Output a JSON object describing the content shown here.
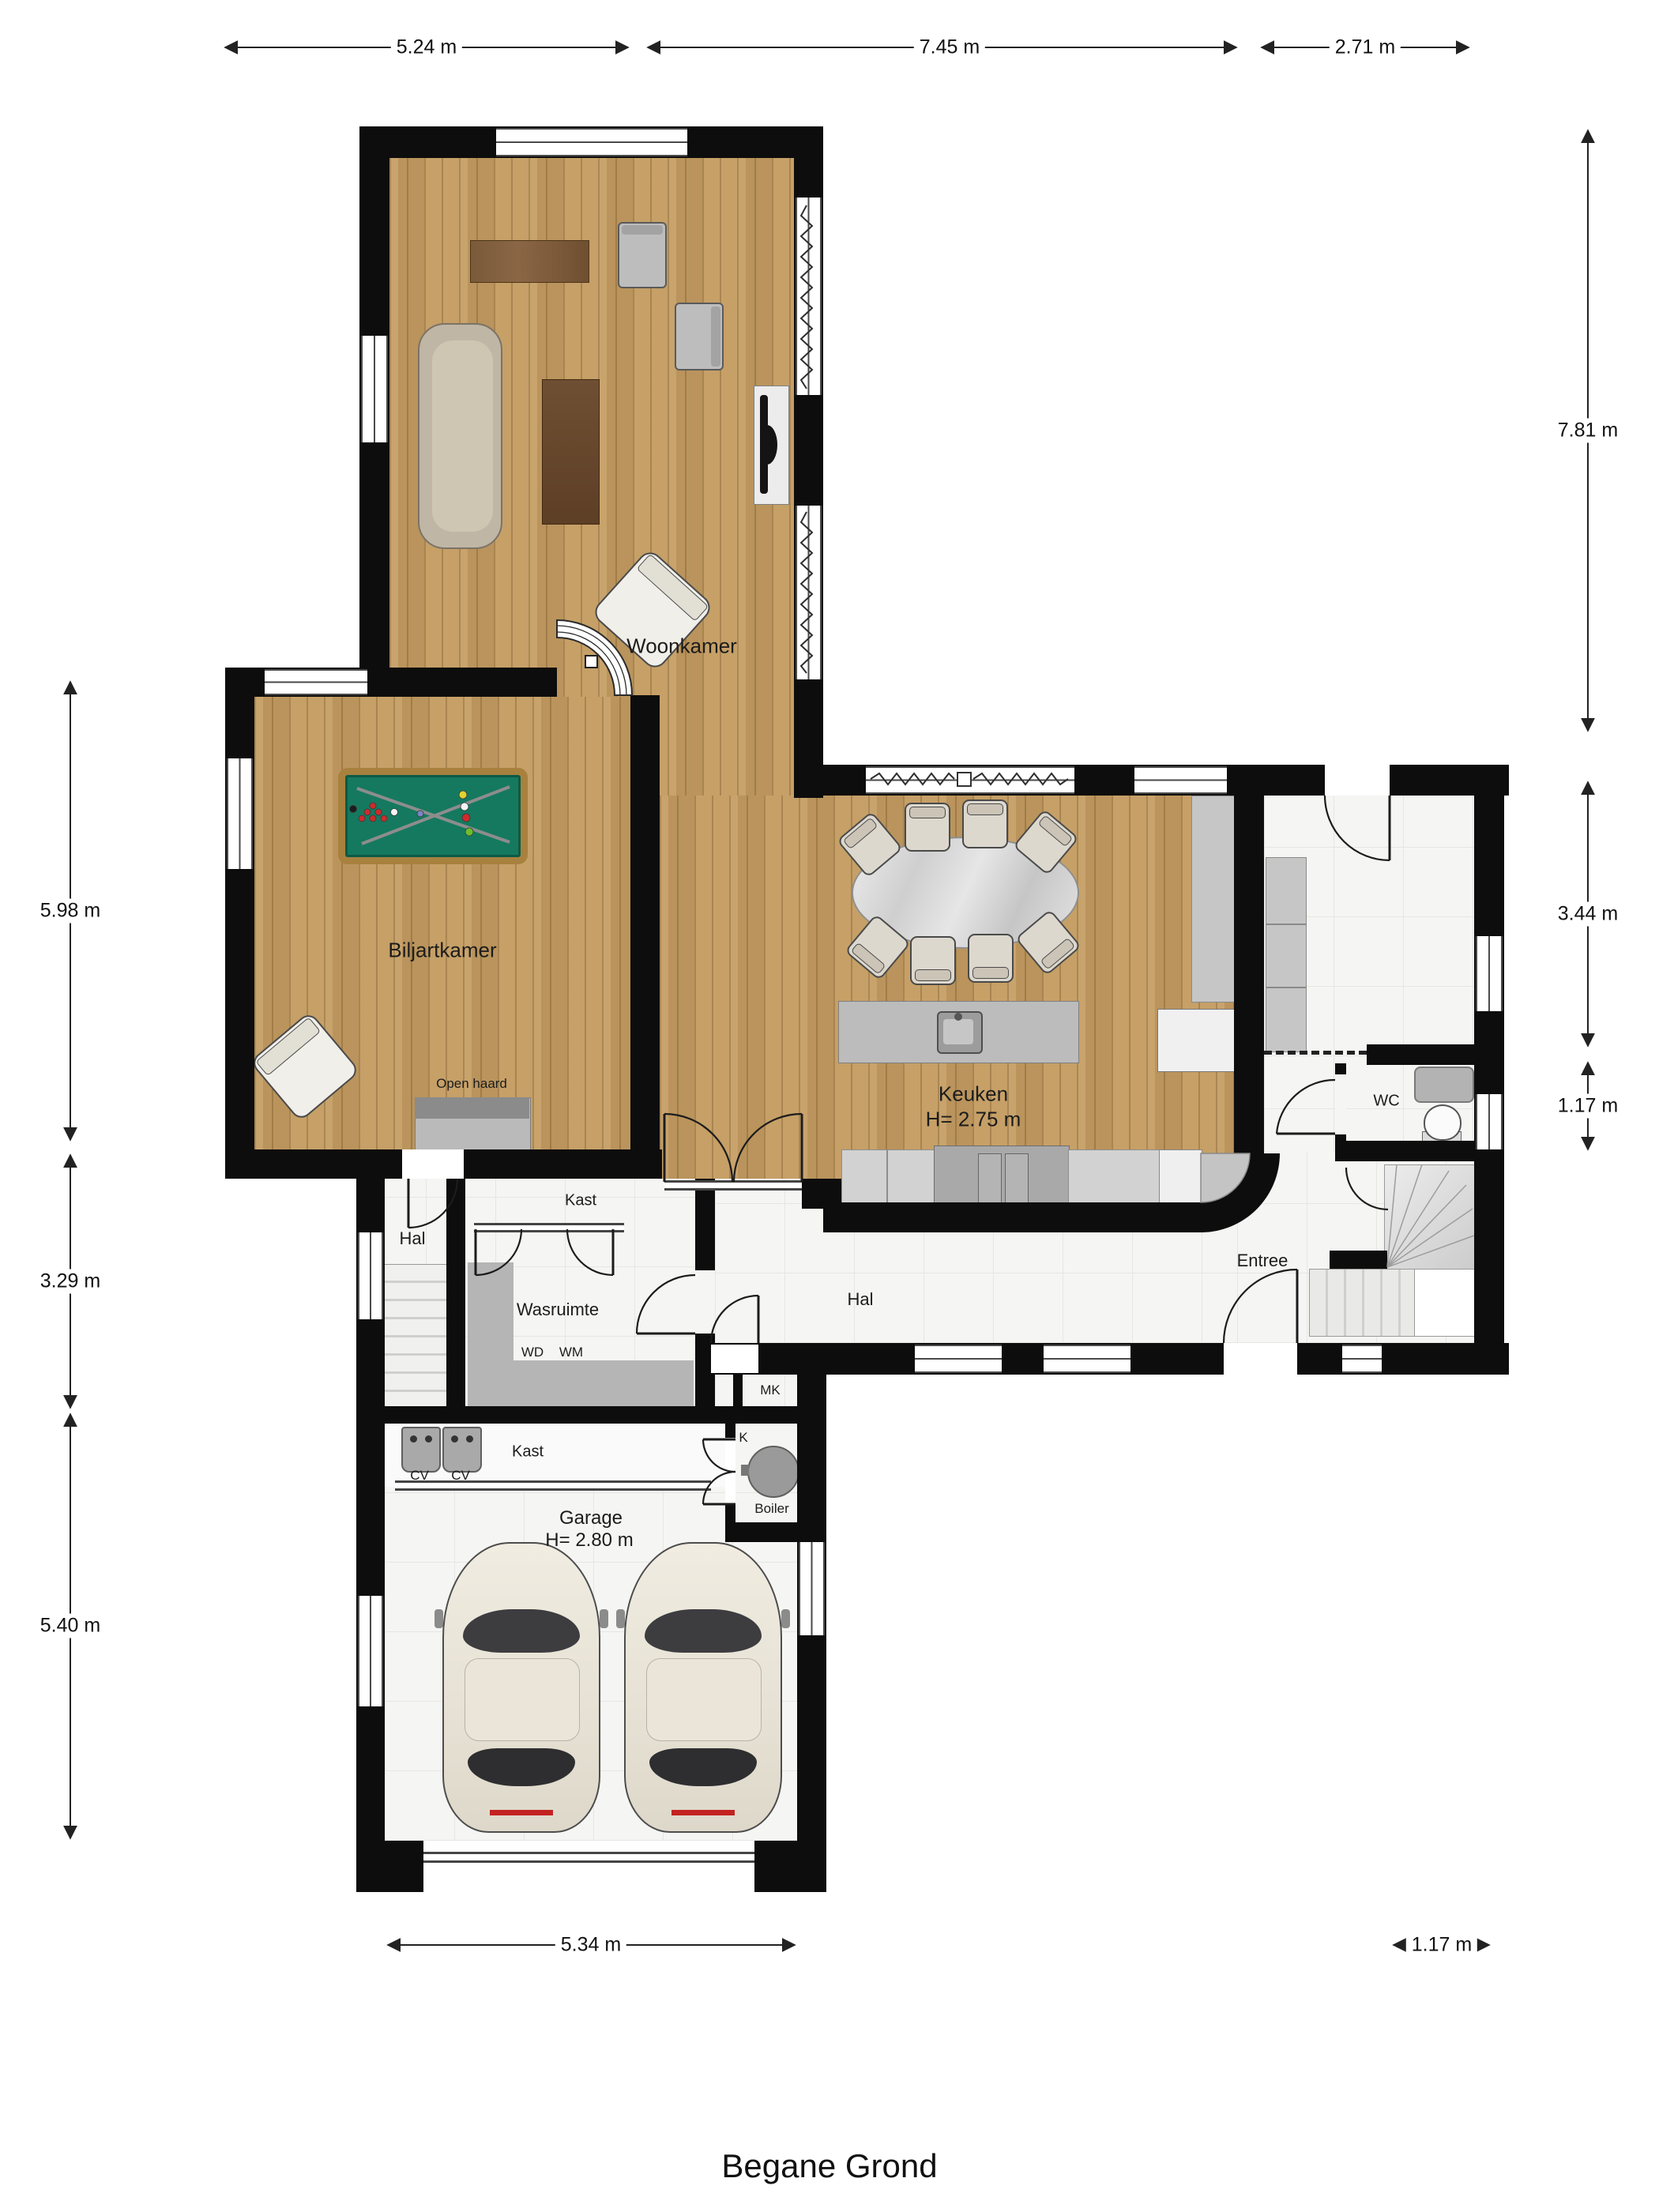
{
  "title": "Begane Grond",
  "rooms": {
    "woonkamer": {
      "label": "Woonkamer"
    },
    "biljartkamer": {
      "label": "Biljartkamer"
    },
    "keuken": {
      "label": "Keuken",
      "height": "H= 2.75 m"
    },
    "garage": {
      "label": "Garage",
      "height": "H= 2.80 m"
    },
    "hal_left": {
      "label": "Hal"
    },
    "hal_main": {
      "label": "Hal"
    },
    "entree": {
      "label": "Entree"
    },
    "wasruimte": {
      "label": "Wasruimte"
    },
    "kast_top": {
      "label": "Kast"
    },
    "kast_garage": {
      "label": "Kast"
    },
    "wc": {
      "label": "WC"
    },
    "open_haard": {
      "label": "Open haard"
    }
  },
  "appliances": {
    "wd": "WD",
    "wm": "WM",
    "cv_left": "CV",
    "cv_right": "CV",
    "mk": "MK",
    "k": "K",
    "boiler": "Boiler"
  },
  "dimensions": {
    "top": [
      "5.24 m",
      "7.45 m",
      "2.71 m"
    ],
    "right": [
      "7.81 m",
      "3.44 m",
      "1.17 m"
    ],
    "left": [
      "5.98 m",
      "3.29 m",
      "5.40 m"
    ],
    "bottom": [
      "5.34 m",
      "1.17 m"
    ]
  },
  "colors": {
    "wall": "#0d0d0d",
    "wood": "#c49c61",
    "tile": "#f5f5f3",
    "billiard_felt": "#15795f",
    "accent_red": "#c32222"
  }
}
